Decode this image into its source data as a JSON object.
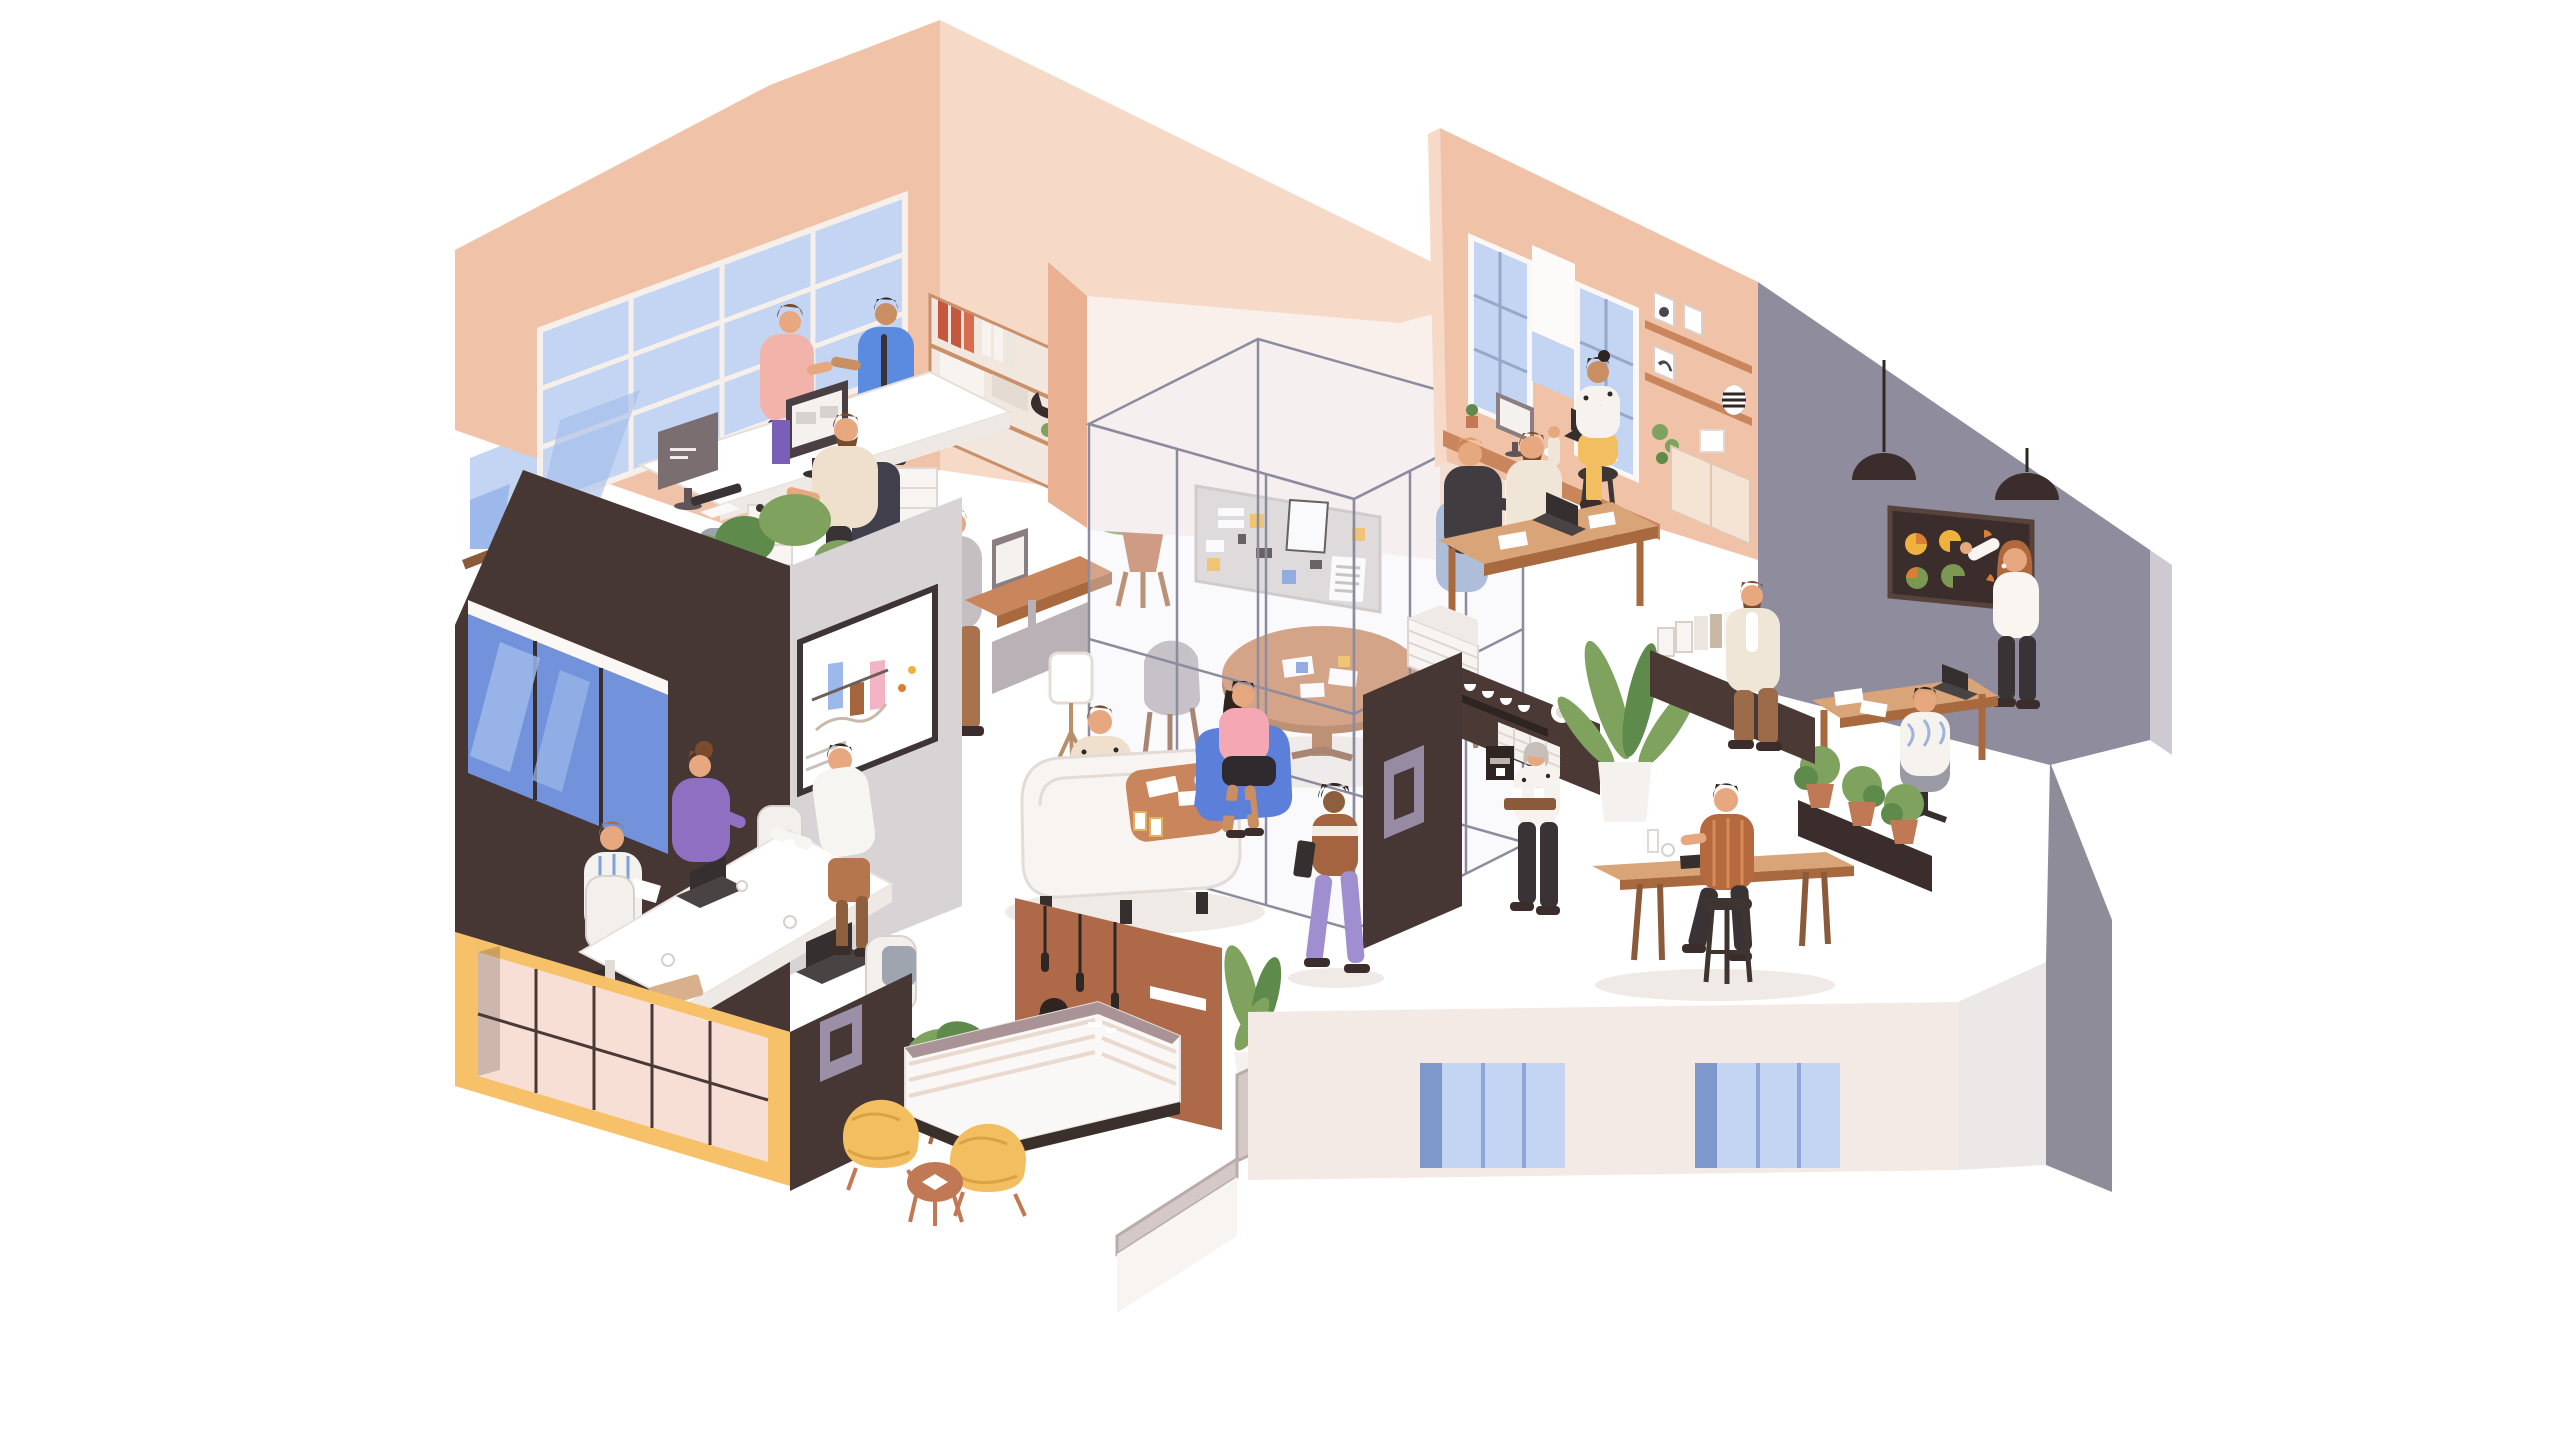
{
  "illustration": {
    "type": "isometric-office-cutaway",
    "description": "Flat-style isometric cutaway illustration of a two-storey coworking office full of people: an open-plan office, a meeting room with a whiteboard bar chart, a reception lobby with yellow ball chairs, a transparent glass meeting cube with a mood board, a lounge, a coffee bar, a studio office with tall windows, and a gray presentation room with a dark pie-chart board.",
    "areas": [
      {
        "id": "open-office",
        "label": "Open-plan office with large grid window",
        "people": [
          "man in pink sweater talking",
          "man in blue jacket with tie",
          "bearded worker seated at double desk",
          "man in gray cardigan at standing desk"
        ],
        "objects": [
          "blue grid window",
          "double desk with two monitors",
          "bookshelf with red and white binders",
          "hanging planter",
          "plant rack with blue teapot",
          "yellow armchair",
          "tall potted plant"
        ]
      },
      {
        "id": "glass-cube",
        "label": "Glass meeting cube with mood board",
        "people": [],
        "objects": [
          "wireframe glass cube",
          "gray mood board with cards and yellow and blue sticky notes",
          "round wooden table with papers",
          "two gray shell chairs"
        ]
      },
      {
        "id": "studio-office",
        "label": "Studio office with tall windows",
        "people": [
          "woman in dotted top and yellow trousers on a stool",
          "blonde man in charcoal sweater",
          "bearded man in cream shirt gesturing"
        ],
        "objects": [
          "two tall blue windows",
          "white roller banner",
          "window ledge desk with monitor, cactus and laptop",
          "wall shelves with framed prints and striped vase",
          "cream credenza",
          "wooden desk with laptop",
          "white drawer unit"
        ]
      },
      {
        "id": "presentation-room",
        "label": "Gray presentation room with pie-chart board",
        "people": [
          "woman presenting at the dark board",
          "man seen from behind on a gray office chair"
        ],
        "objects": [
          "two black dome pendant lamps",
          "dark board with yellow, orange and green pie charts",
          "wooden desk with laptop and papers",
          "dark planter with three potted shrubs"
        ]
      },
      {
        "id": "coffee-bar",
        "label": "Coffee bar and kitchen",
        "people": [
          "gray-haired woman carrying a tray with two cups",
          "man standing by the sideboard"
        ],
        "objects": [
          "dark bar with purple square frame",
          "shelf with white cups and plates",
          "white tile backsplash",
          "coffee machine",
          "large plant in white pot",
          "dark sideboard with books and binders"
        ]
      },
      {
        "id": "meeting-room",
        "label": "Meeting room with whiteboard bar chart",
        "people": [
          "man in striped shirt with papers",
          "woman in purple sweater at laptop",
          "person in white shirt leaning over the table"
        ],
        "objects": [
          "whiteboard with blue, brown and pink bars",
          "white conference table",
          "two dark laptops",
          "white office chairs",
          "big blue window in dark wall"
        ]
      },
      {
        "id": "lounge",
        "label": "Lounge with booth sofa",
        "people": [
          "man in polka-dot shirt at the booth table",
          "woman in pink top and black skirt in a blue armchair",
          "walking woman in purple trousers holding a tablet"
        ],
        "objects": [
          "white high-back booth sofa",
          "wooden coffee table with papers and striped cups",
          "blue armchair",
          "white tripod floor lamp"
        ]
      },
      {
        "id": "reception",
        "label": "Reception lobby",
        "people": [
          "receptionist with dark bob behind the counter"
        ],
        "objects": [
          "rust wall with three pendant lights and white sign slot",
          "white reception counter with mauve top",
          "potted plant",
          "two yellow ball chairs",
          "round side table",
          "leafy plant in white pot"
        ]
      },
      {
        "id": "cafe-corner",
        "label": "Cafe corner with high table",
        "people": [
          "man in rust striped shirt on a tall stool"
        ],
        "objects": [
          "long high wooden table",
          "cup and tablet",
          "dark stool",
          "planter box with potted shrubs"
        ]
      },
      {
        "id": "building-shell",
        "label": "Building shell, stairs and lower facade",
        "people": [],
        "objects": [
          "white outer wall with two blue windows",
          "yellow ground-floor facade with pink glass grid",
          "dark corner wall with purple square frame",
          "gray staircase parapet",
          "cream lower facade with three blue window strips",
          "gray corner wedge walls"
        ]
      }
    ],
    "boards": {
      "meeting_whiteboard": {
        "type": "bar",
        "bars": [
          {
            "color_key": "barBlue"
          },
          {
            "color_key": "barBrown"
          },
          {
            "color_key": "barPink"
          }
        ]
      },
      "dark_pie_board": {
        "type": "pies",
        "colors_keys": [
          "chartYellow",
          "chartOrange",
          "chartGreen"
        ],
        "layout": "two rows of three circular charts"
      }
    }
  },
  "palette": {
    "bg": "#FFFFFF",
    "peach": "#F0C3A8",
    "peachDeep": "#E9B092",
    "peachPale": "#F7D9C8",
    "blush": "#F9F0EC",
    "darkBrown": "#463634",
    "darkBrown2": "#3A2D2B",
    "rust": "#AE6A48",
    "gray": "#8F8C9E",
    "grayLight": "#CFC9D2",
    "creamWall": "#F3E9E5",
    "stairGray": "#D4C9C7",
    "yellow": "#F6C169",
    "pinkPane": "#F8DFD6",
    "windowBlue": "#C3D5F2",
    "windowBlueMid": "#9DB8EA",
    "windowBlueDeep": "#7293DB",
    "glass": "#8C8C9E",
    "wood": "#C9855B",
    "woodLight": "#D9A478",
    "woodDeep": "#A8693F",
    "offWhite": "#F4F1EF",
    "furnGray": "#B7AFB4",
    "green": "#7FA35F",
    "greenDeep": "#5E8A4C",
    "terracotta": "#C07954",
    "skin": "#E8A87F",
    "skinDeep": "#8D5F3F",
    "skinMid": "#C98E62",
    "yellowSeat": "#F2BE5F",
    "blueChair": "#5C7FD9",
    "blueJacket": "#5B8BE0",
    "purple": "#8F6FC2",
    "lilac": "#A08FD0",
    "pink": "#F3A8B3",
    "pinkSweater": "#F2B3AB",
    "charcoal": "#3A3335",
    "beige": "#EFE0CE",
    "cream": "#EFE6D8",
    "chartYellow": "#F0B23E",
    "chartOrange": "#D97E35",
    "chartGreen": "#7C9752",
    "barBlue": "#8FB1E8",
    "barBrown": "#A4643C",
    "barPink": "#F2B3C4",
    "boardGray": "#D8D3D1",
    "hairBrown": "#7B4B2E",
    "hairDark": "#2E2521",
    "hairBlonde": "#D9A55F",
    "hairAuburn": "#B0693C",
    "hairGray": "#C6BFB9",
    "shadow": "#F0EAE6"
  }
}
